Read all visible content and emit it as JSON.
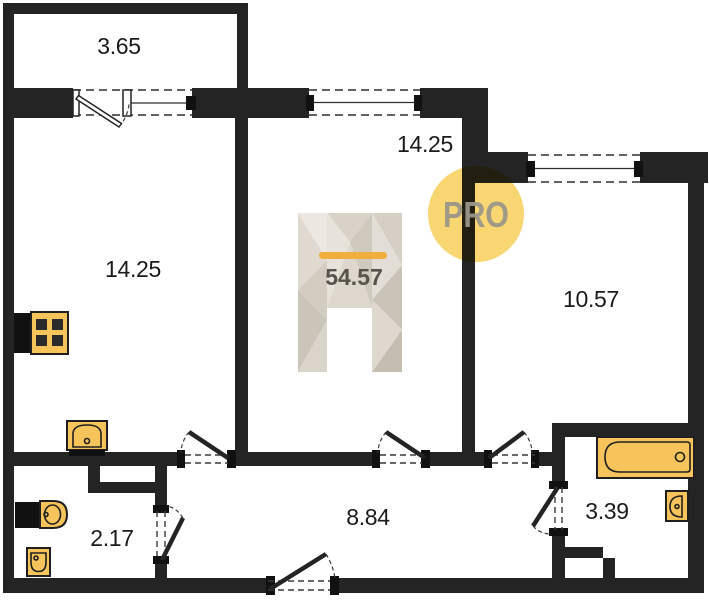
{
  "title": "Apartment floor plan",
  "badge": {
    "label": "PRO"
  },
  "watermark": {
    "total_area": "54.57",
    "brand_mark": "H"
  },
  "rooms": [
    {
      "name": "balcony",
      "area": "3.65"
    },
    {
      "name": "kitchen",
      "area": "14.25"
    },
    {
      "name": "room-middle",
      "area": "14.25"
    },
    {
      "name": "room-right",
      "area": "10.57"
    },
    {
      "name": "hallway",
      "area": "8.84"
    },
    {
      "name": "wc",
      "area": "2.17"
    },
    {
      "name": "bathroom",
      "area": "3.39"
    }
  ],
  "fixtures": [
    "stove-icon",
    "kitchen-sink-icon",
    "toilet-icon",
    "corner-sink-icon",
    "bathtub-icon",
    "washbasin-icon"
  ],
  "colors": {
    "wall": "#242424",
    "fixture_fill": "#F6C45A",
    "badge_fill": "#F8D671",
    "badge_text": "#9B968A",
    "accent_bar": "#F0AF3C",
    "total_text": "#57534B",
    "label_text": "#1B1B1B"
  }
}
